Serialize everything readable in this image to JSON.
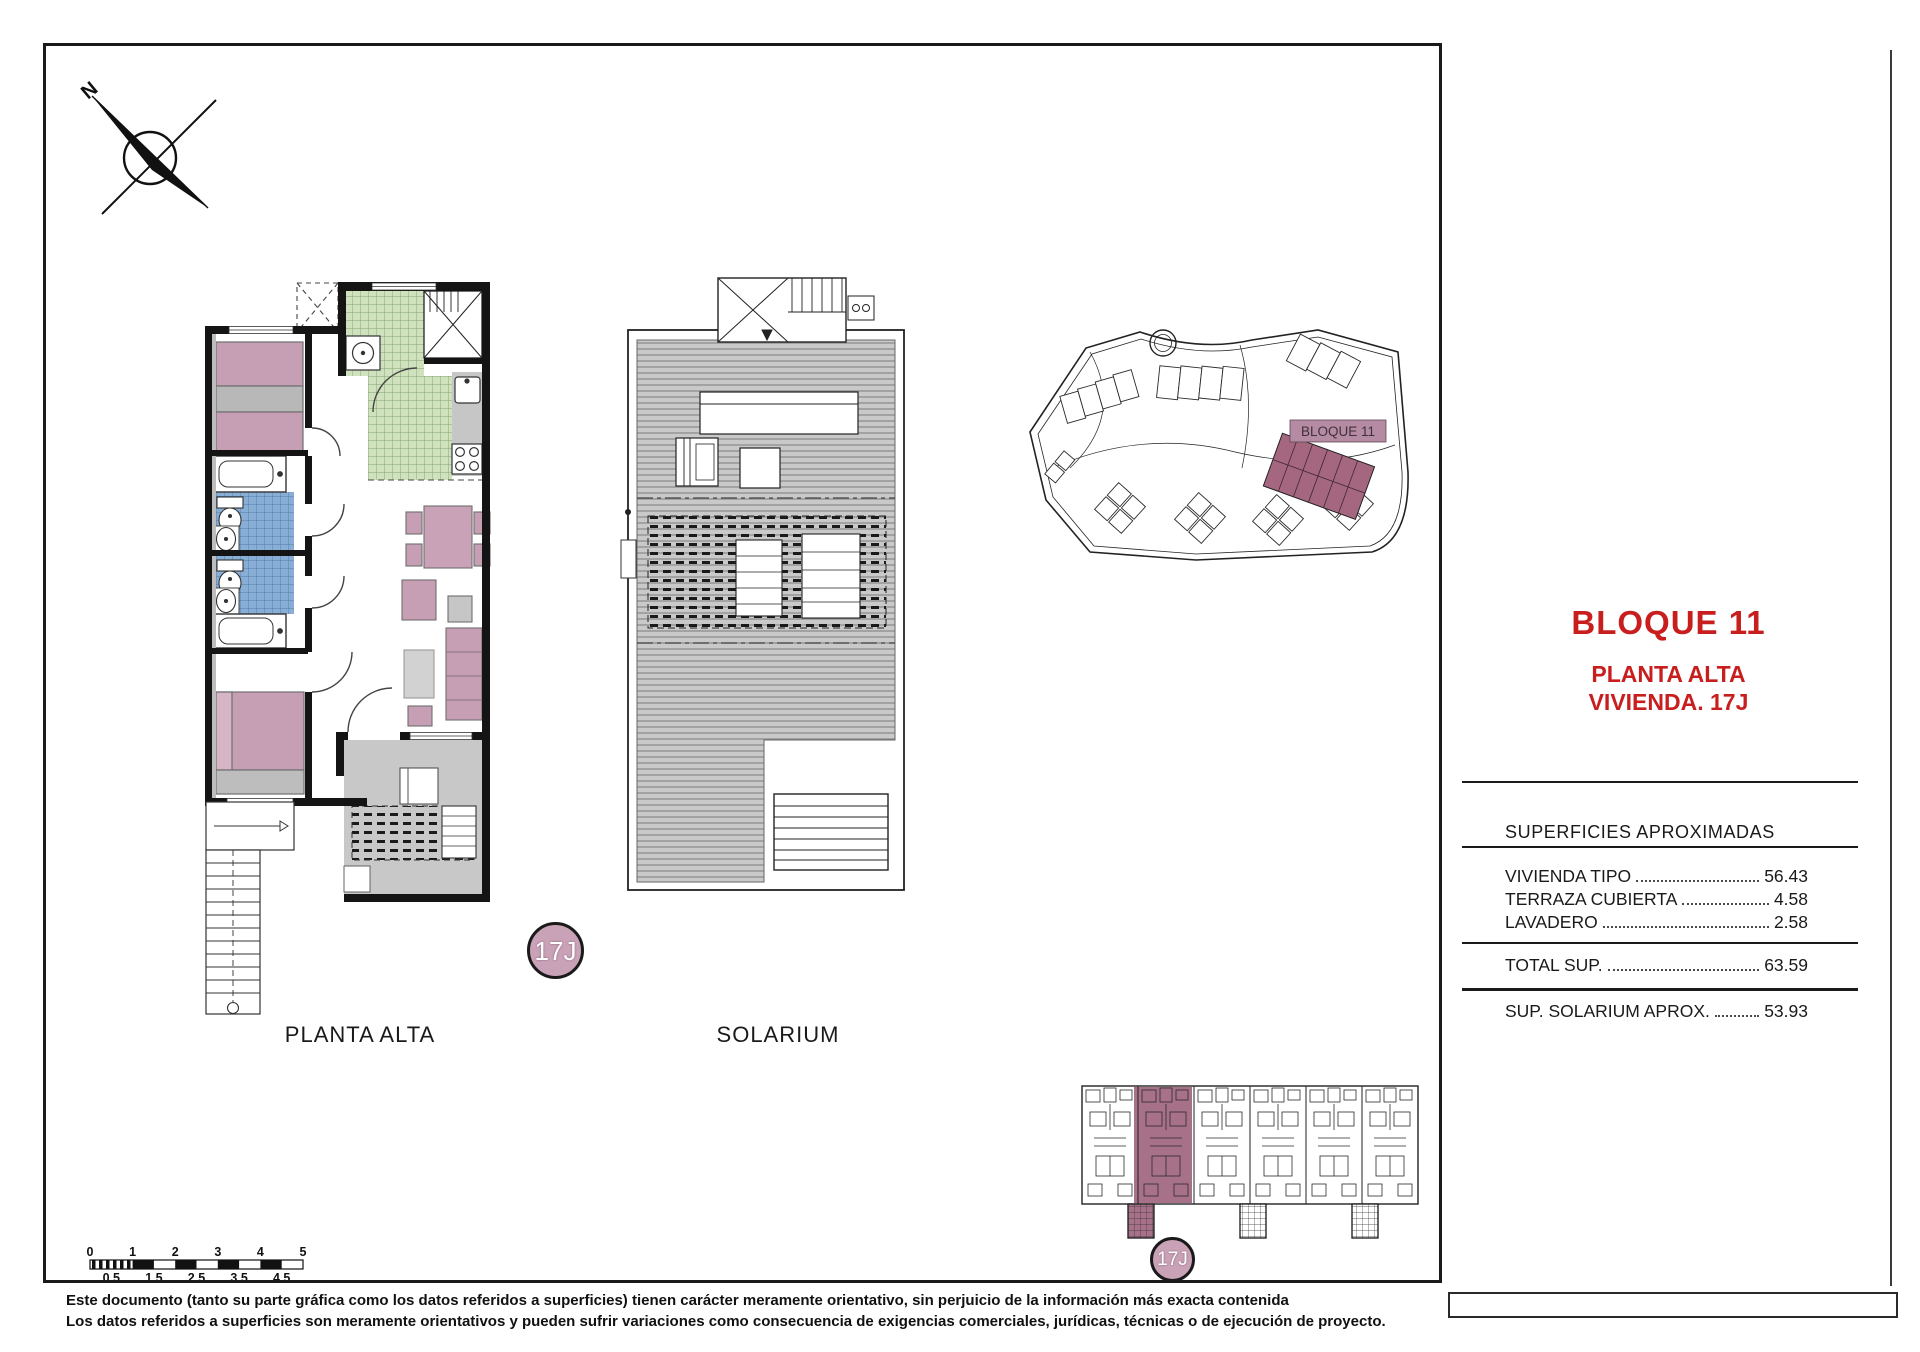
{
  "sheet": {
    "north_letter": "N",
    "labels": {
      "planta_alta": "PLANTA ALTA",
      "solarium": "SOLARIUM"
    },
    "unit_badge": "17J",
    "site_plan": {
      "block_label": "BLOQUE 11"
    },
    "title_block": {
      "block": "BLOQUE 11",
      "floor": "PLANTA ALTA",
      "unit": "VIVIENDA. 17J"
    },
    "surfaces": {
      "heading": "SUPERFICIES APROXIMADAS",
      "rows": [
        {
          "label": "VIVIENDA TIPO",
          "value": "56.43"
        },
        {
          "label": "TERRAZA CUBIERTA",
          "value": "4.58"
        },
        {
          "label": "LAVADERO",
          "value": "2.58"
        }
      ],
      "total": {
        "label": "TOTAL SUP.",
        "value": "63.59"
      },
      "solarium_row": {
        "label": "SUP. SOLARIUM APROX.",
        "value": "53.93"
      }
    },
    "scale_bar": {
      "top": [
        "0",
        "1",
        "2",
        "3",
        "4",
        "5"
      ],
      "bottom": [
        "0.5",
        "1.5",
        "2.5",
        "3.5",
        "4.5"
      ]
    },
    "disclaimer": {
      "line1": "Este documento (tanto su parte gráfica como los datos referidos a superficies) tienen carácter meramente orientativo, sin perjuicio de la información más exacta contenida",
      "line2": "Los datos referidos a superficies son meramente orientativos y pueden sufrir variaciones como consecuencia de exigencias comerciales, jurídicas, técnicas o de ejecución de proyecto."
    },
    "colors": {
      "accent_red": "#c81e1e",
      "furniture_mauve": "#c79fb4",
      "highlight_mauve": "#a8718a",
      "badge_mauve": "#c9a2b8",
      "tile_green": "#cfe1bd",
      "tile_blue": "#88aed6",
      "terrace_gray": "#c8c8c8"
    }
  }
}
